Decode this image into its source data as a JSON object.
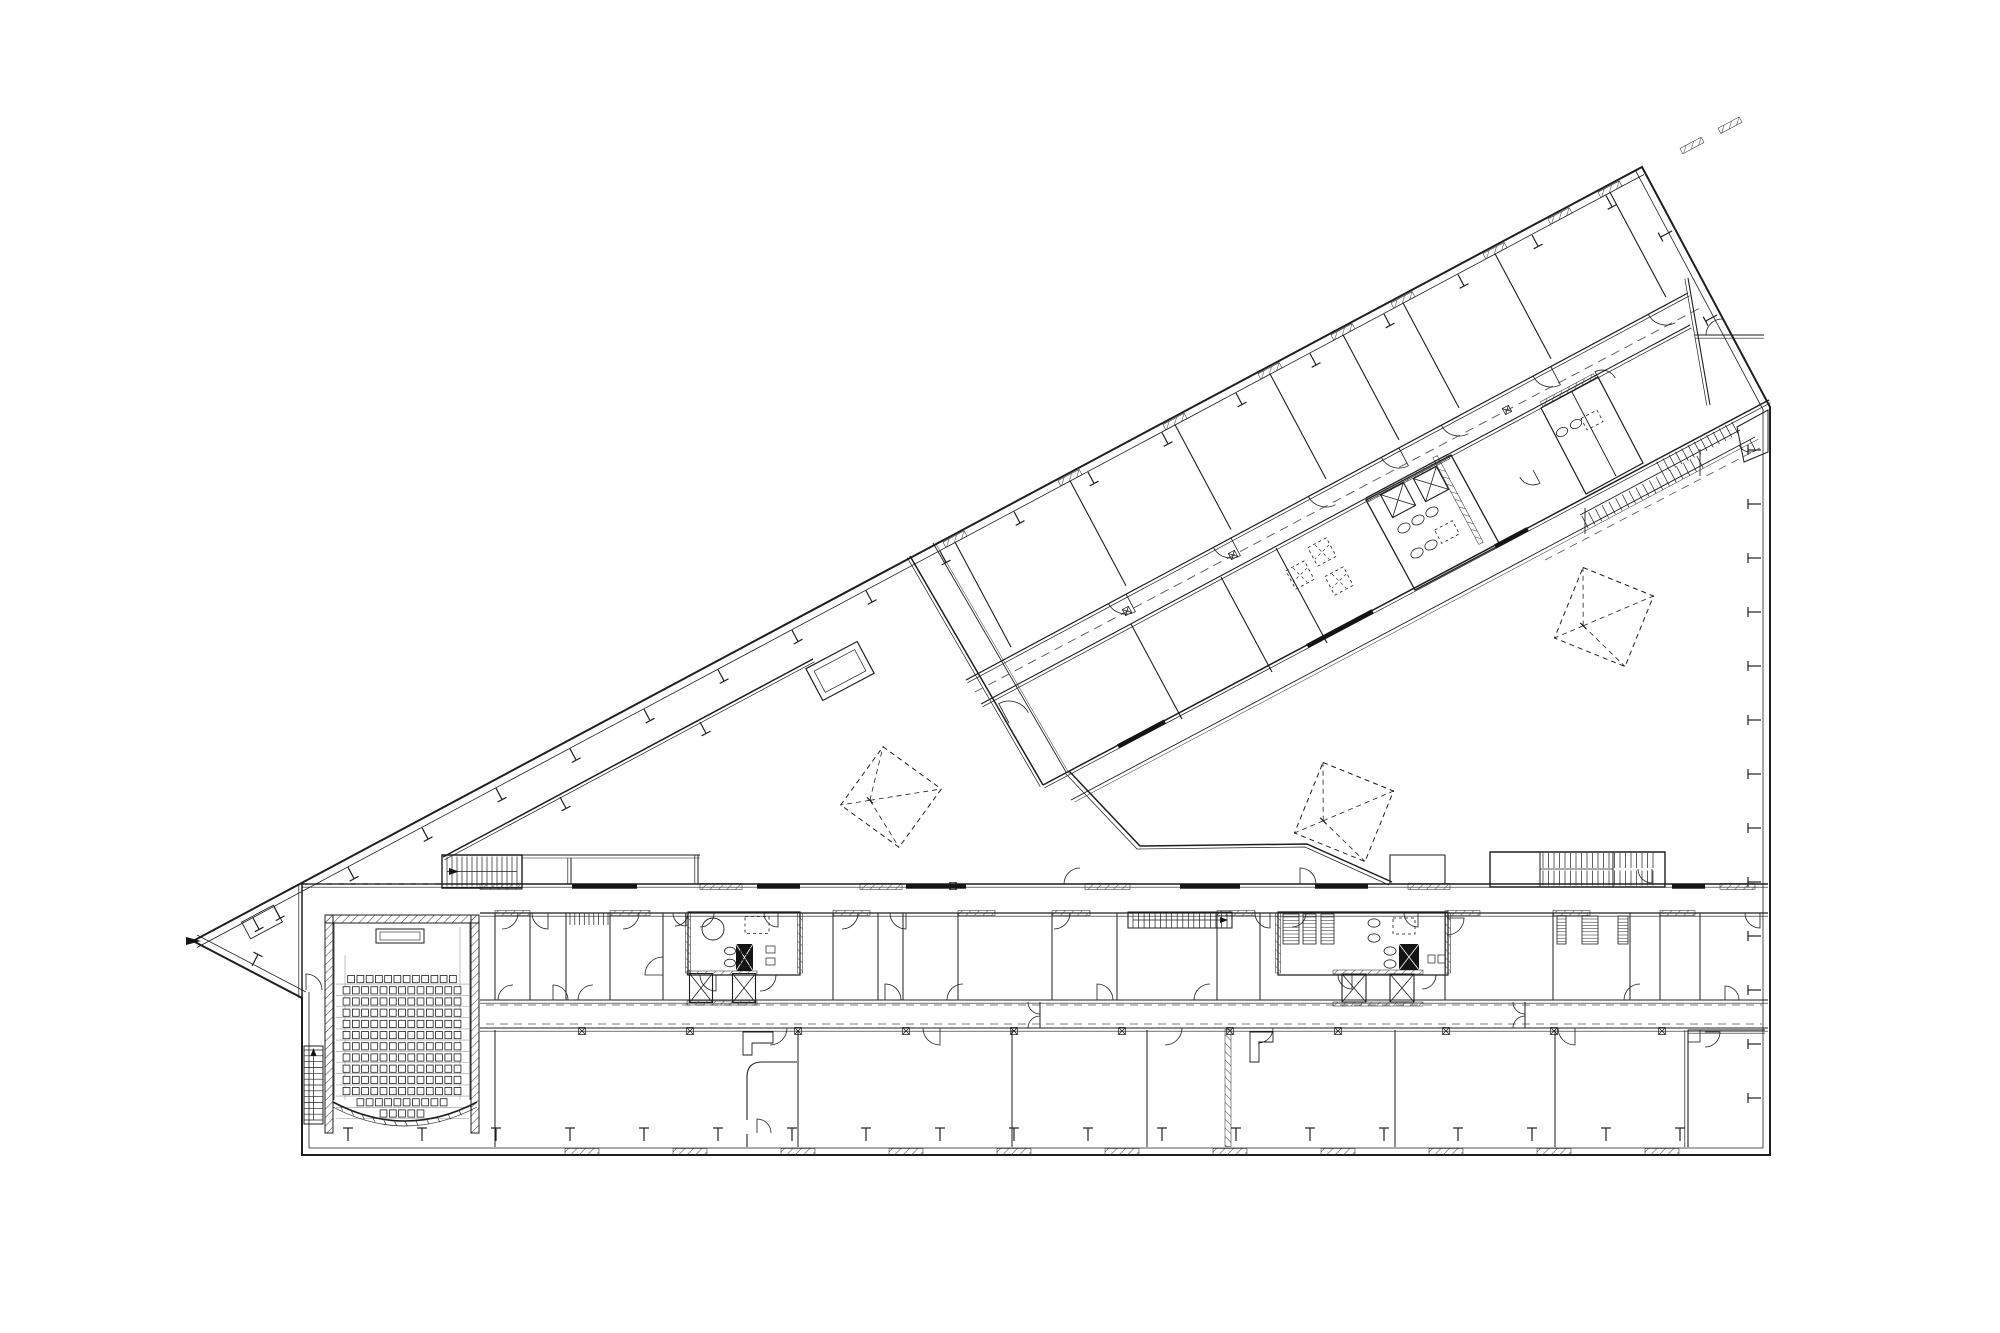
{
  "colors": {
    "background": "#ffffff",
    "ink": "#1f1f1f",
    "ink_light": "#555555",
    "guide": "#9a9a9a",
    "solid_fill": "#141414"
  },
  "plan": {
    "type": "architectural-floor-plan",
    "auditorium": {
      "seat_rows": [
        12,
        13,
        13,
        13,
        13,
        13,
        13,
        13,
        13,
        13,
        13,
        10,
        5
      ],
      "has_stage": true,
      "side_stair_treads": 12
    },
    "stairs": {
      "atrium_left_block_treads": 14,
      "lower_wing_mid_treads": 17,
      "lower_wing_top_block_treads": 20,
      "upper_wing_run1_treads": 17,
      "upper_wing_run2_treads": 12,
      "small_room_stair_treads": 8
    },
    "elevators": {
      "upper_wing": 2,
      "lower_wing_left": 2,
      "lower_wing_right": 2
    },
    "skylights": {
      "large": 3,
      "small": 3
    },
    "column_markers_corridor": 11
  }
}
